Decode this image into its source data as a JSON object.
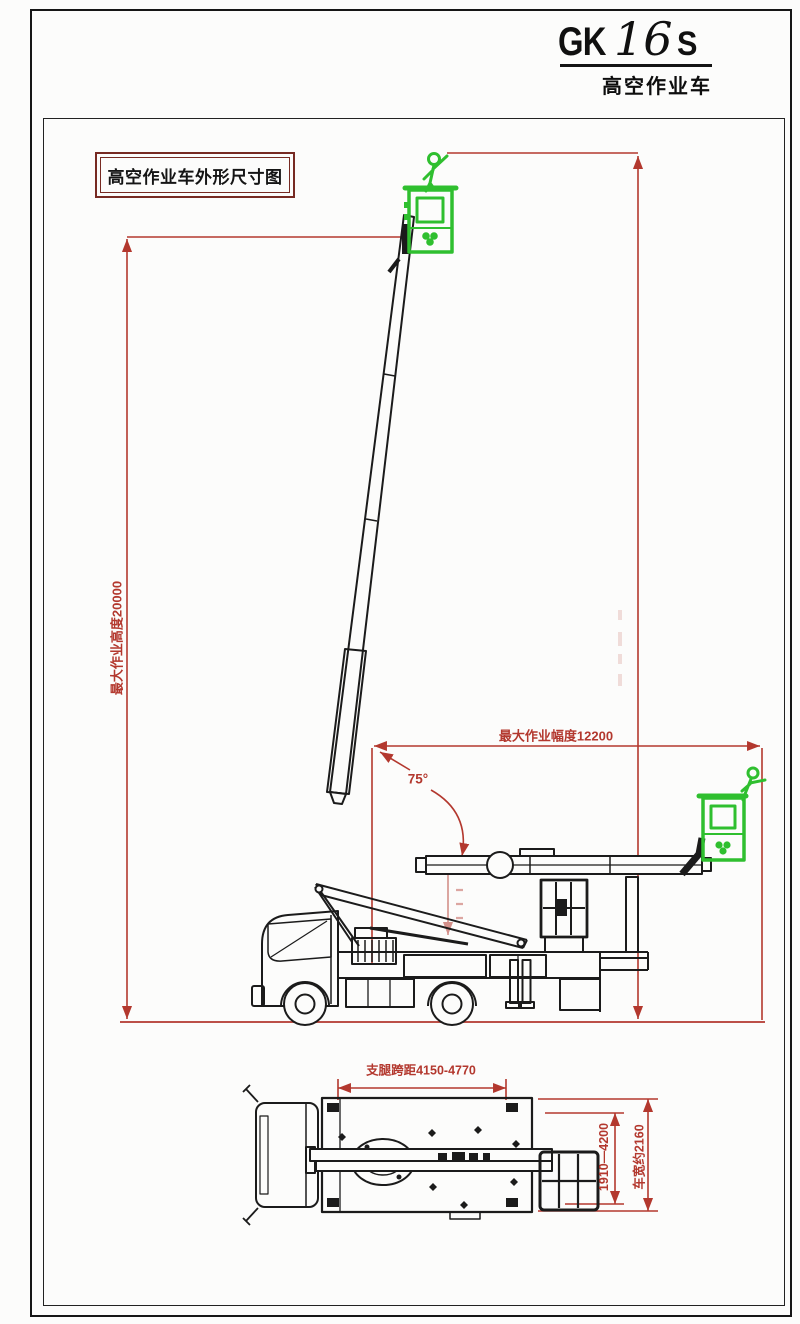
{
  "title_block": {
    "model_prefix": "GK",
    "model_number": "16",
    "model_suffix": "S",
    "subtitle": "高空作业车"
  },
  "caption_box": {
    "label": "高空作业车外形尺寸图"
  },
  "dimensions": {
    "max_working_height": "最大作业高度20000",
    "max_outreach": "最大作业幅度12200",
    "boom_angle": "75°",
    "outrigger_span": "支腿跨距4150-4770",
    "outrigger_extension_range": "1910—4200",
    "vehicle_width": "车宽约2160"
  },
  "colors": {
    "dimension_red": "#b3382e",
    "basket_green": "#2fbf2f",
    "line_black": "#1b1b1b",
    "paper_white": "#fcfcfb"
  },
  "icons": {
    "operator_figure": "operator-figure-icon",
    "basket_logo": "clover-logo-icon"
  }
}
